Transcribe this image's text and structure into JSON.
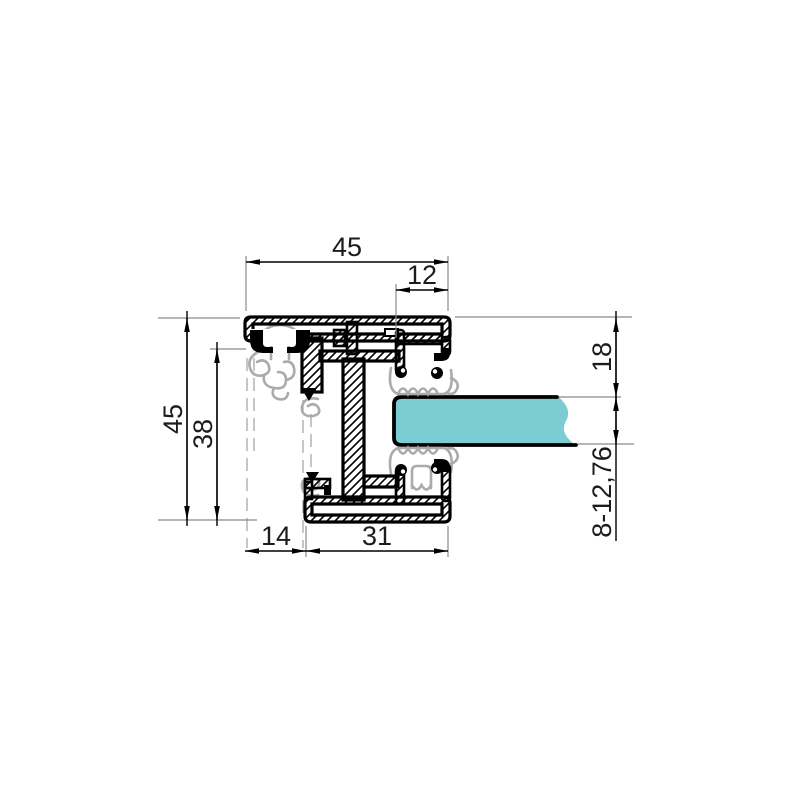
{
  "page": {
    "background": "#ffffff"
  },
  "drawing": {
    "type": "aluminium-profile-cross-section",
    "labels": {
      "top_width": "45",
      "bead_width": "12",
      "overall_height": "45",
      "inner_height": "38",
      "top_to_glass": "18",
      "glass_thickness": "8-12,76",
      "bottom_offset": "14",
      "bottom_width": "31"
    },
    "colors": {
      "glass": "#7ccdd3",
      "gasket": "#ababab",
      "metal_outline": "#000000",
      "dimension_line": "#000000",
      "extension_line": "#8a8a8a",
      "text": "#1c1c1c"
    }
  }
}
